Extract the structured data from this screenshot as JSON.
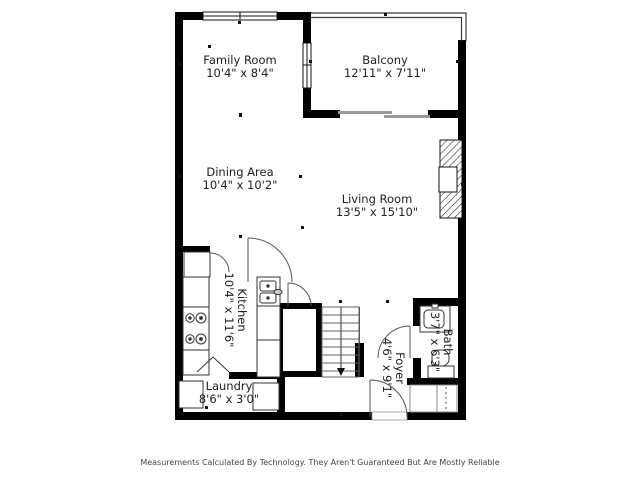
{
  "floorplan": {
    "rooms": [
      {
        "name": "Family Room",
        "dims": "10'4\" x 8'4\""
      },
      {
        "name": "Balcony",
        "dims": "12'11\" x 7'11\""
      },
      {
        "name": "Dining Area",
        "dims": "10'4\" x 10'2\""
      },
      {
        "name": "Living Room",
        "dims": "13'5\" x 15'10\""
      },
      {
        "name": "Kitchen",
        "dims": "10'4\" x 11'6\""
      },
      {
        "name": "Laundry",
        "dims": "8'6\" x 3'0\""
      },
      {
        "name": "Foyer",
        "dims": "4'6\" x 9'1\""
      },
      {
        "name": "Bath",
        "dims": "3'7\" x 6'3\""
      }
    ],
    "fixtures": [
      "fireplace",
      "stove",
      "kitchen-sink",
      "pantry-closet",
      "stairs-down",
      "washer",
      "dryer",
      "bath-vanity",
      "toilet",
      "closet-rod",
      "sliding-glass-door",
      "entry-door"
    ],
    "disclaimer": "Measurements Calculated By Technology. They Aren't Guaranteed But Are Mostly Reliable",
    "colors": {
      "wall": "#000000",
      "background": "#ffffff",
      "thin_line": "#555555",
      "slider": "#9a9a9a",
      "text": "#222222"
    }
  }
}
